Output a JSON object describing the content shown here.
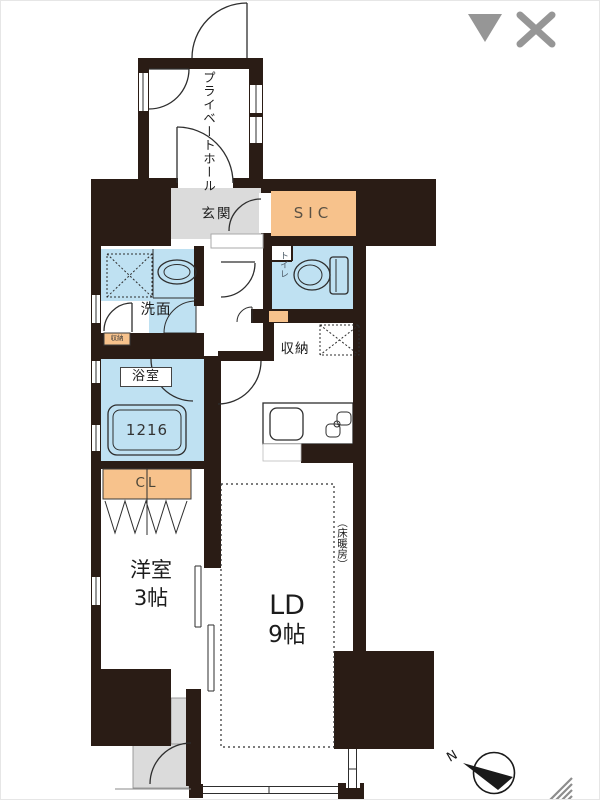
{
  "ui": {
    "collapse_icon": "triangle-down",
    "close_icon": "close-x",
    "resize_grip": "diagonal-resize-grip"
  },
  "colors": {
    "wall": "#2a1c15",
    "room_blue": "#bfe1f2",
    "fixture_blue": "#d6edf9",
    "accent_orange": "#f7c28c",
    "floor_gray": "#dbdbdb",
    "ui_icon_gray": "#969696",
    "line": "#2e2e2e"
  },
  "floorplan": {
    "labels": {
      "private_hall": "プライベートホール",
      "entrance": "玄関",
      "sic": "SIC",
      "washroom": "洗面",
      "washroom_cabinet": "収納",
      "toilet": "トイレ",
      "storage": "収納",
      "bathroom": "浴室",
      "bathtub_size": "1216",
      "closet": "CL",
      "western_room": "洋室",
      "western_room_size": "3帖",
      "living_dining": "LD",
      "living_dining_size": "9帖",
      "floor_heating": "（床暖房）"
    },
    "compass": {
      "north_label": "N"
    }
  }
}
